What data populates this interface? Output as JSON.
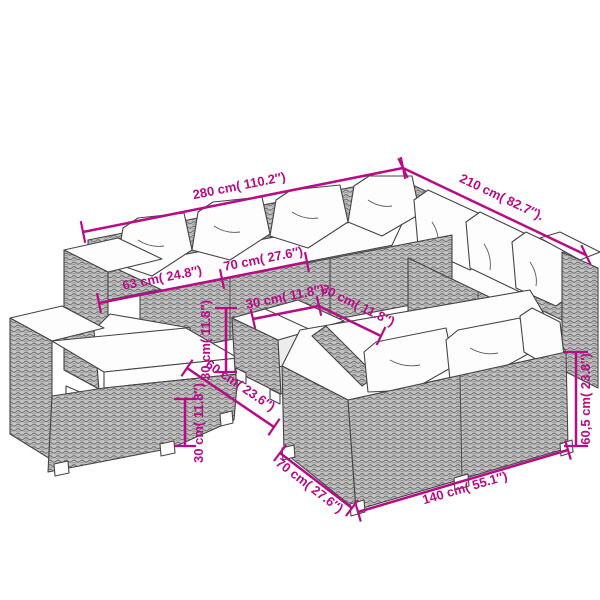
{
  "diagram": {
    "kind": "product-dimension-sketch",
    "subject": "rattan garden lounge furniture set",
    "background": "#ffffff",
    "dimension_color": "#b70c86",
    "dimensions": {
      "total_width": {
        "cm": "280",
        "inches": "110.2",
        "label": "280 cm( 110.2″)"
      },
      "total_depth": {
        "cm": "210",
        "inches": "82.7",
        "label": "210 cm( 82.7″)."
      },
      "arm_width": {
        "cm": "63",
        "inches": "24.8",
        "label": "63 cm( 24.8″)"
      },
      "seat_width": {
        "cm": "70",
        "inches": "27.6",
        "label": "70 cm( 27.6″)"
      },
      "table_top_a": {
        "cm": "30",
        "inches": "11.8",
        "label": "30 cm( 11.8″)"
      },
      "table_top_b": {
        "cm": "30",
        "inches": "11.8",
        "label": "30 cm( 11.8″)"
      },
      "table_height": {
        "cm": "30",
        "inches": "11.8",
        "label": "30 cm( 11.8″)"
      },
      "table_length": {
        "cm": "60",
        "inches": "23.6",
        "label": "60 cm( 23.6″)"
      },
      "seat_height": {
        "cm": "30",
        "inches": "11.8",
        "label": "30 cm( 11.8″)"
      },
      "sofa_depth": {
        "cm": "70",
        "inches": "27.6",
        "label": "70 cm( 27.6″)"
      },
      "sofa_width": {
        "cm": "140",
        "inches": "55.1",
        "label": "140 cm( 55.1″)"
      },
      "sofa_back_height": {
        "cm": "60,5",
        "inches": "23.8",
        "label": "60,5 cm( 23.8″)"
      }
    }
  }
}
